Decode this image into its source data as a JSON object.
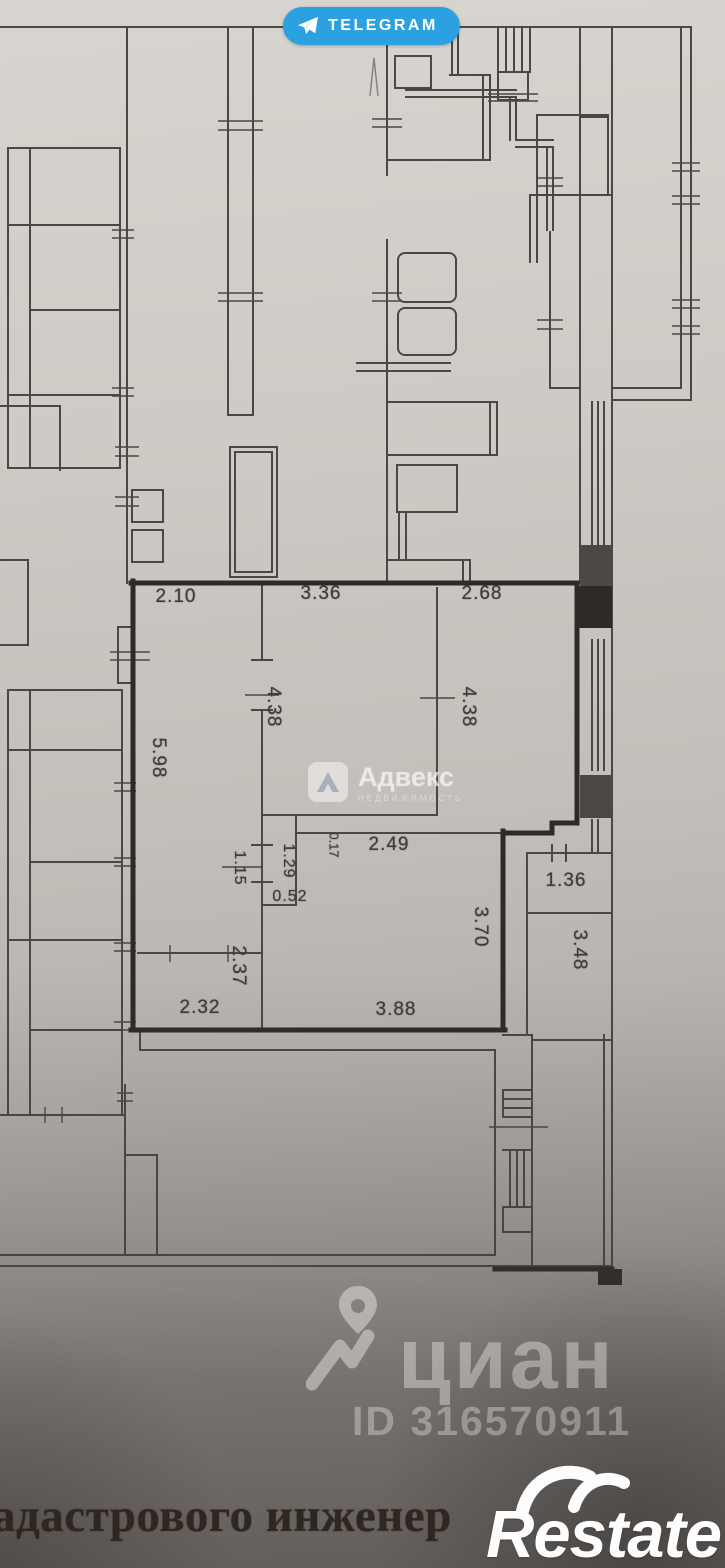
{
  "watermarks": {
    "telegram": {
      "label": "TELEGRAM"
    },
    "advex": {
      "name": "Адвекс",
      "subtitle": "НЕДВИЖИМОСТЬ"
    },
    "cian": {
      "name": "циан",
      "listing_id": "ID 316570911"
    },
    "restate": {
      "name": "Restate"
    }
  },
  "document": {
    "caption_fragment": "адастрового инженер"
  },
  "floor_plan": {
    "dimensions": {
      "hall_top_width": "2.10",
      "room_mid_top_width": "3.36",
      "room_right_top_width": "2.68",
      "room_mid_depth": "4.38",
      "room_right_depth": "4.38",
      "hall_left_depth": "5.98",
      "corridor_width": "2.49",
      "wall_offset": "0.17",
      "duct_depth": "1.29",
      "passage_width": "1.15",
      "duct_width": "0.52",
      "niche_width": "1.36",
      "small_room_depth": "2.37",
      "small_room_width": "2.32",
      "living_width": "3.88",
      "living_depth": "3.70",
      "loggia_depth": "3.48"
    }
  },
  "colors": {
    "telegram_blue": "#2ba1e2",
    "wall_ink": "#4b4744",
    "wall_ink_bold": "#2d2a28",
    "caption_ink": "#2f261f",
    "watermark_white": "rgba(255,255,255,0.4)"
  }
}
